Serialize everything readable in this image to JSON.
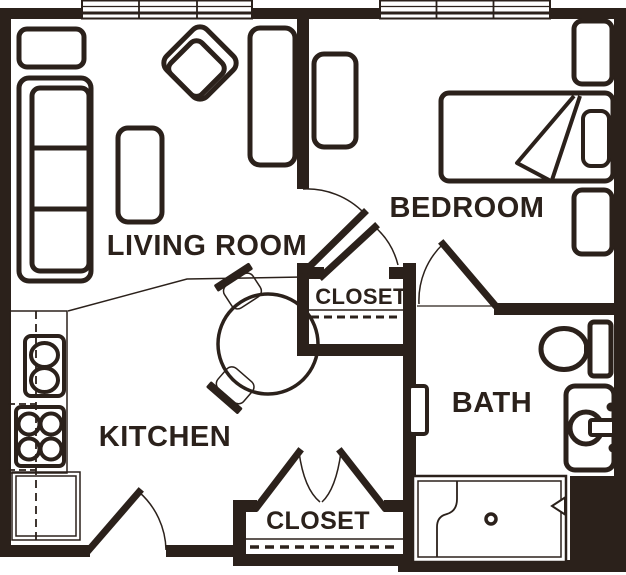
{
  "colors": {
    "ink": "#2b211b",
    "paper": "#ffffff"
  },
  "rooms": {
    "living": {
      "label": "LIVING ROOM"
    },
    "bedroom": {
      "label": "BEDROOM"
    },
    "kitchen": {
      "label": "KITCHEN"
    },
    "bath": {
      "label": "BATH"
    },
    "closet_upper": {
      "label": "CLOSET"
    },
    "closet_lower": {
      "label": "CLOSET"
    }
  },
  "furniture": {
    "living": [
      "sofa",
      "armchair",
      "loveseat",
      "side-chair",
      "end-table"
    ],
    "dining": [
      "round-table",
      "dining-chair",
      "dining-chair"
    ],
    "kitchen": [
      "counter",
      "double-sink",
      "stove",
      "refrigerator"
    ],
    "bedroom": [
      "bed",
      "pillow",
      "dresser",
      "nightstand",
      "nightstand"
    ],
    "bath": [
      "toilet",
      "vanity-sink",
      "shower"
    ]
  },
  "openings": {
    "windows": 2,
    "doors": [
      "entry-door",
      "bedroom-door",
      "closet-door",
      "bath-door",
      "bifold-closet-doors"
    ]
  }
}
